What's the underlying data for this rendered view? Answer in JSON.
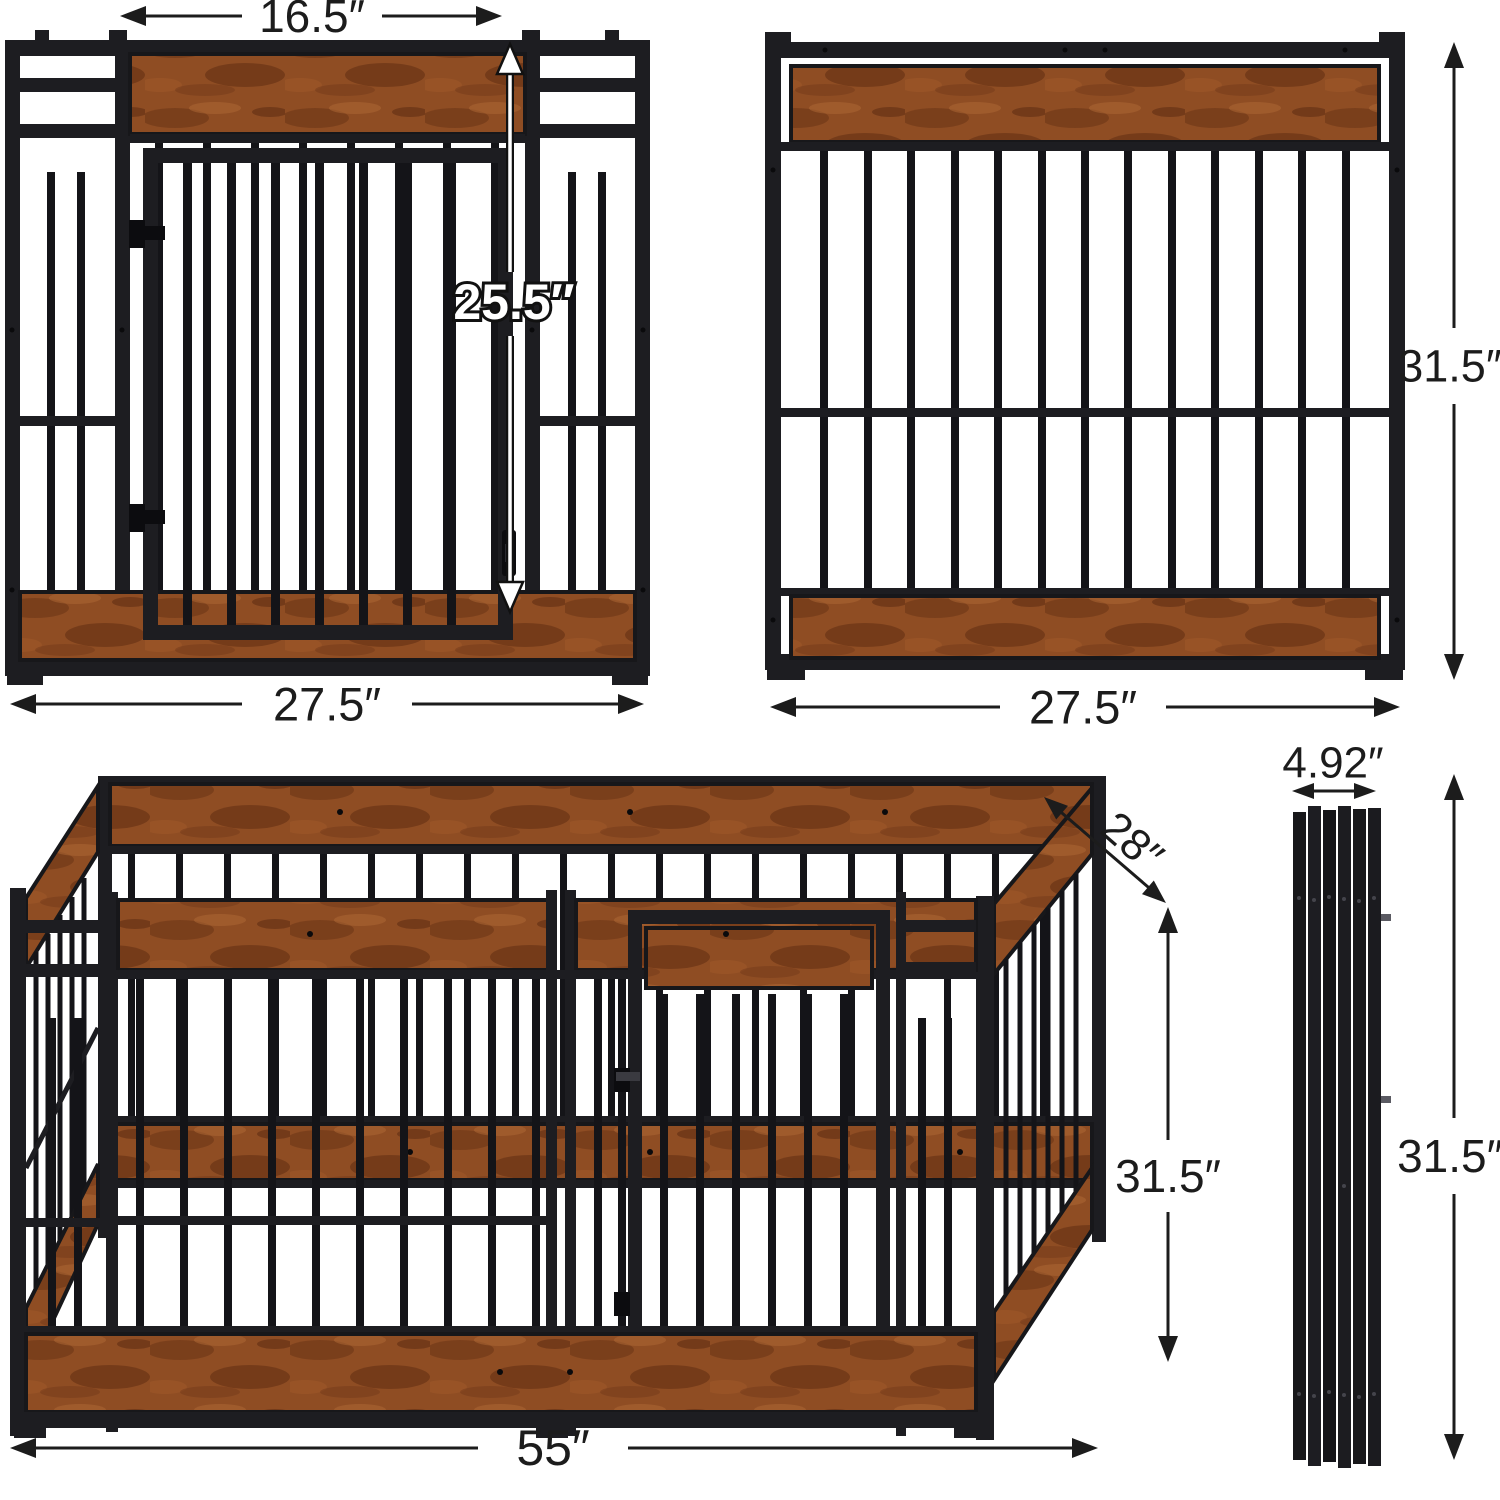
{
  "diagram": {
    "description": "Heavy-duty wood and metal dog playpen dimension diagram with four views",
    "views": {
      "front_panel": "front panel with swing door",
      "back_panel": "barred side panel",
      "assembled_playpen": "assembled playpen 3D view",
      "folded_panels": "folded flat panel stack"
    },
    "dimensions": {
      "door_width": "16.5″",
      "door_height": "25.5″",
      "front_panel_width": "27.5″",
      "back_panel_width": "27.5″",
      "panel_height": "31.5″",
      "pen_depth": "28″",
      "pen_height": "31.5″",
      "folded_stack_width": "4.92″",
      "folded_stack_height": "31.5″",
      "pen_length": "55″"
    },
    "colors": {
      "background": "#ffffff",
      "metal_frame": "#1d1d21",
      "metal_bar": "#141418",
      "wood_base": "#8f4d23",
      "wood_dark": "#5c2a10",
      "wood_light": "#b06a35",
      "dimension_line": "#1c1c1c",
      "door_height_label_fill": "#ffffff",
      "door_height_label_outline": "#111111"
    }
  }
}
